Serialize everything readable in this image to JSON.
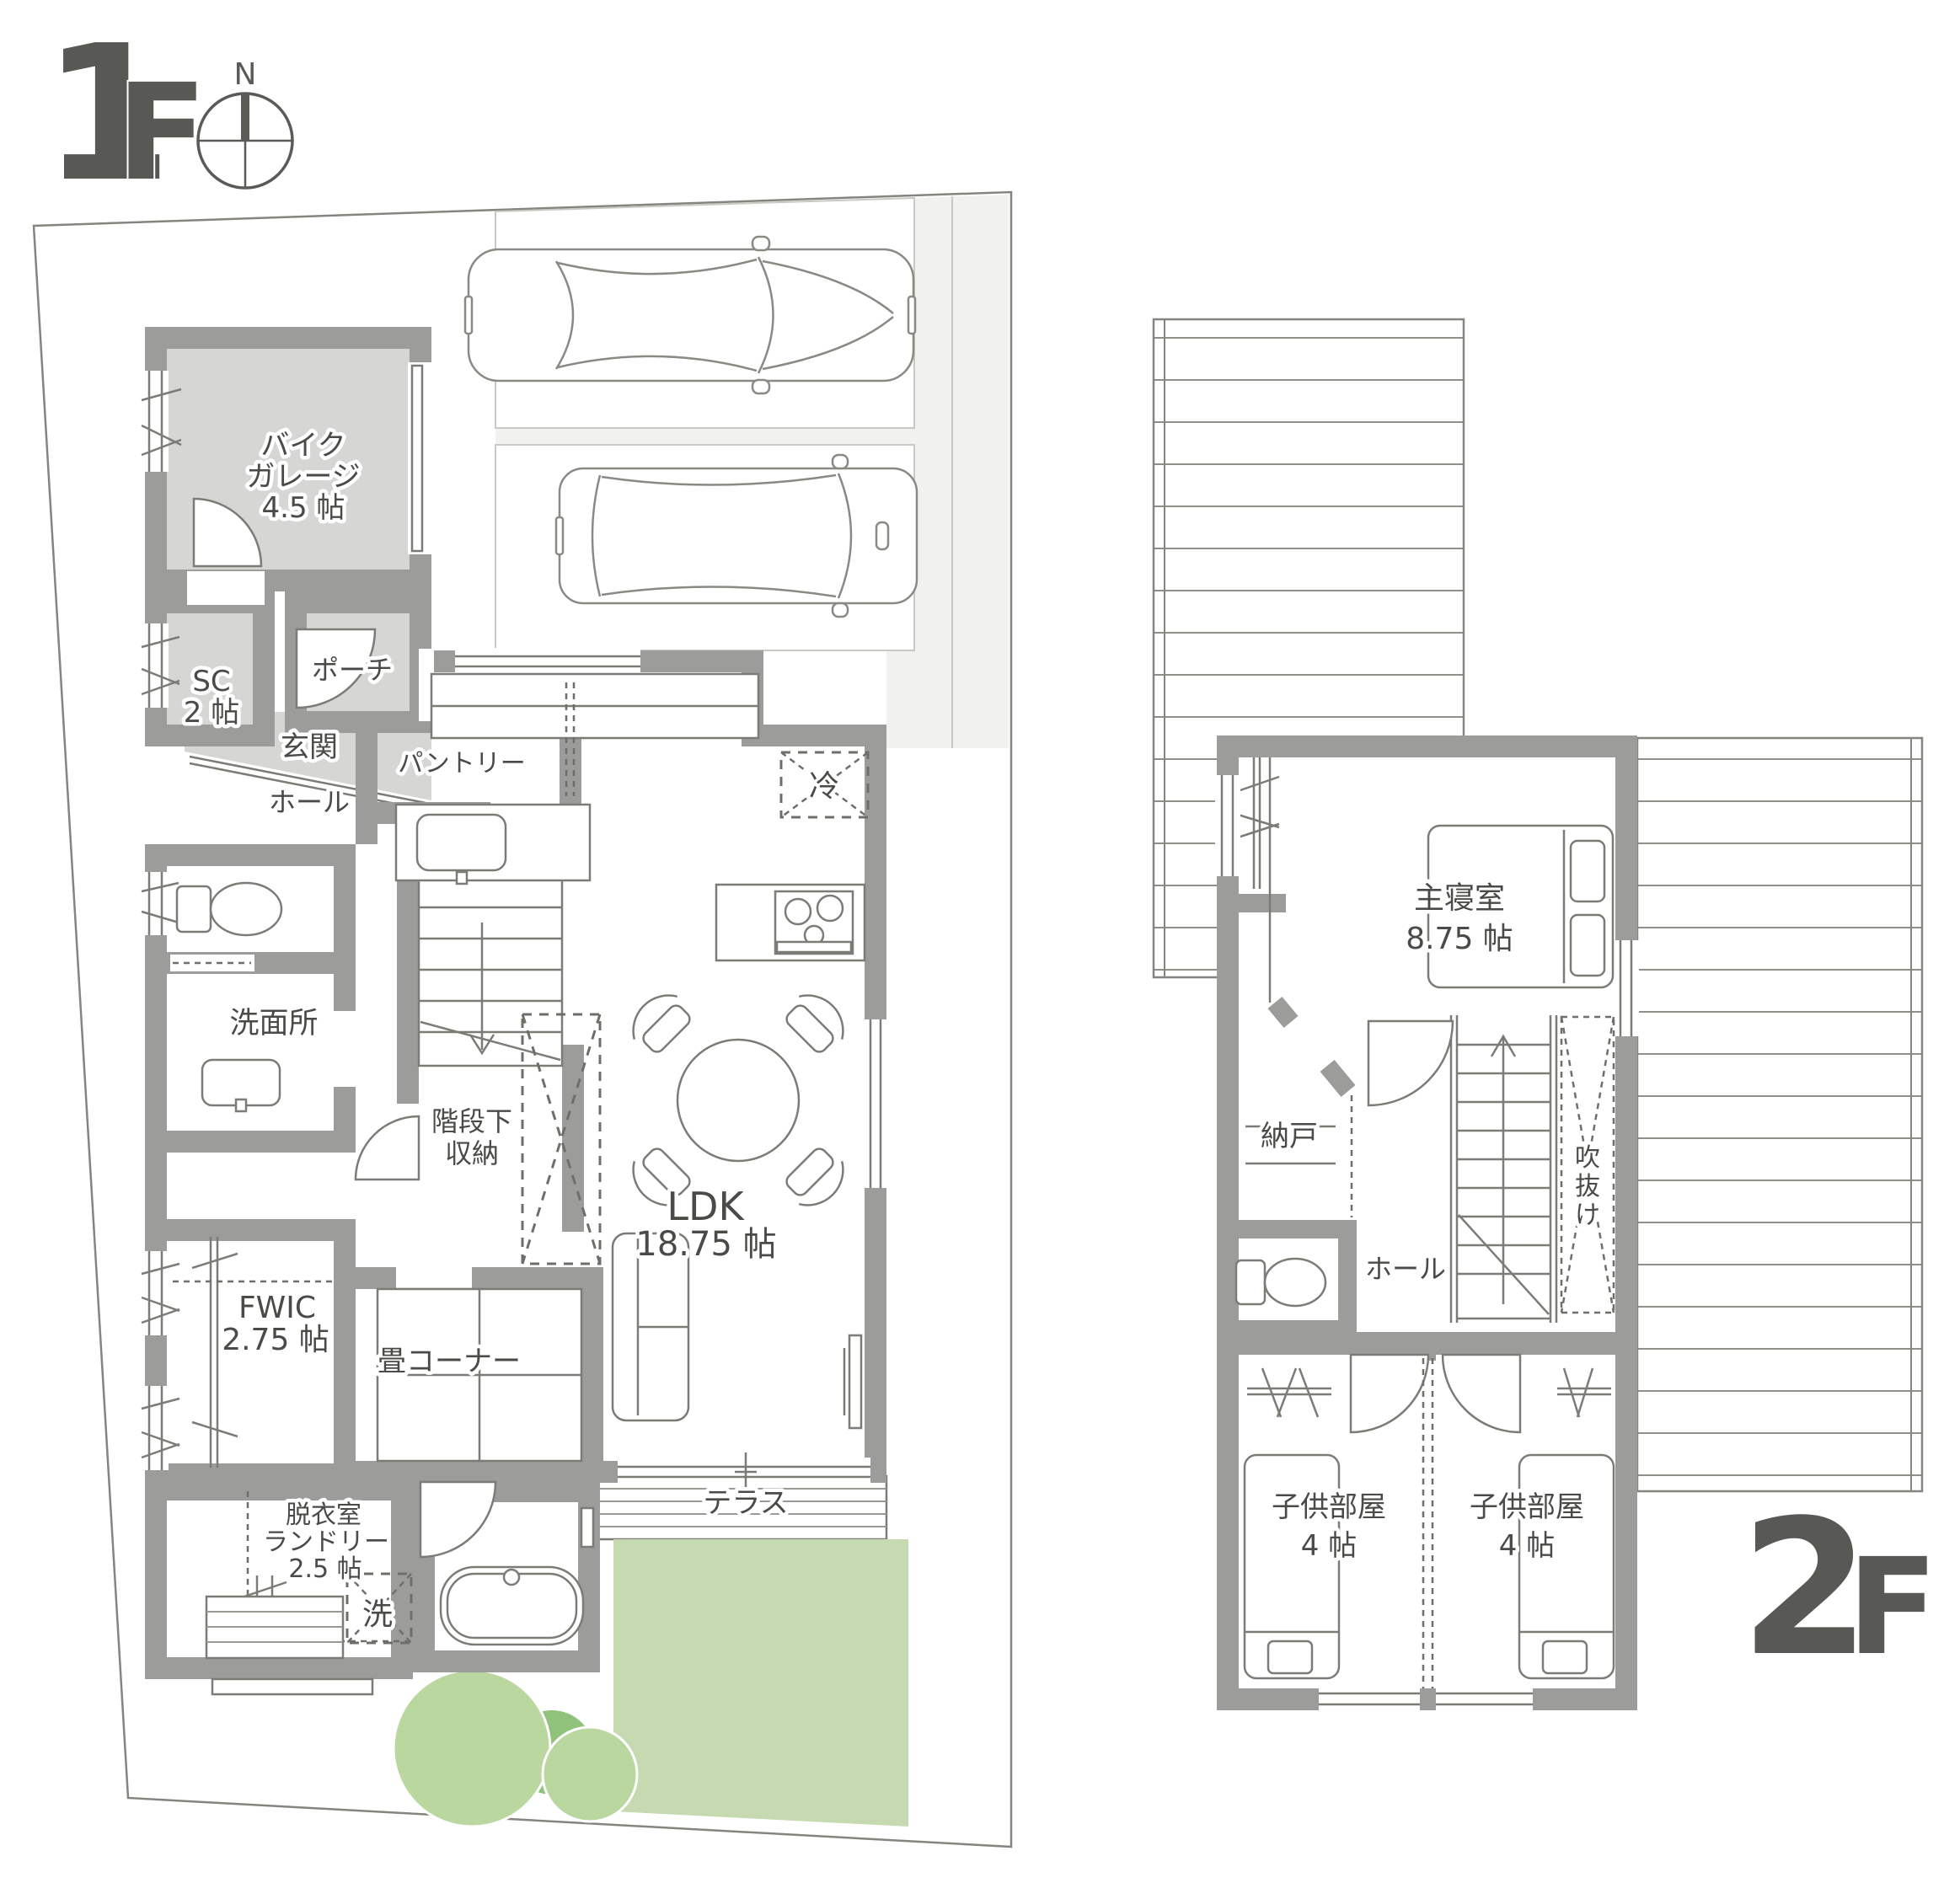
{
  "title": {
    "floor1_number": "1",
    "floor1_suffix": "F",
    "floor2_number": "2",
    "floor2_suffix": "F",
    "compass_north": "N"
  },
  "colors": {
    "wall": "#9c9c9b",
    "room_shade": "#d6d6d4",
    "parking": "#f1f1ef",
    "lawn": "#c6d9b0",
    "tree_light": "#b9d79e",
    "tree_dark": "#8fc37c",
    "label_text": "#4a4a47",
    "floor_label": "#585855"
  },
  "floor1": {
    "rooms": {
      "bike_garage": {
        "lines": [
          "バイク",
          "ガレージ",
          "4.5 帖"
        ]
      },
      "sc": {
        "lines": [
          "SC",
          "2 帖"
        ]
      },
      "porch": {
        "label": "ポーチ"
      },
      "genkan": {
        "label": "玄関"
      },
      "hall": {
        "label": "ホール"
      },
      "pantry": {
        "label": "パントリー"
      },
      "fridge": {
        "label": "冷"
      },
      "washroom": {
        "label": "洗面所"
      },
      "under_stair_storage": {
        "lines": [
          "階段下",
          "収納"
        ]
      },
      "ldk": {
        "lines": [
          "LDK",
          "18.75 帖"
        ]
      },
      "fwic": {
        "lines": [
          "FWIC",
          "2.75 帖"
        ]
      },
      "tatami": {
        "label": "畳コーナー"
      },
      "laundry": {
        "lines": [
          "脱衣室",
          "ランドリー",
          "2.5 帖"
        ]
      },
      "washer": {
        "label": "洗"
      },
      "terrace": {
        "label": "テラス"
      }
    }
  },
  "floor2": {
    "rooms": {
      "master_bedroom": {
        "lines": [
          "主寝室",
          "8.75 帖"
        ]
      },
      "storage": {
        "label": "納戸"
      },
      "hall": {
        "label": "ホール"
      },
      "void": {
        "chars": [
          "吹",
          "抜",
          "け"
        ]
      },
      "kids_room_left": {
        "lines": [
          "子供部屋",
          "4 帖"
        ]
      },
      "kids_room_right": {
        "lines": [
          "子供部屋",
          "4 帖"
        ]
      }
    }
  }
}
